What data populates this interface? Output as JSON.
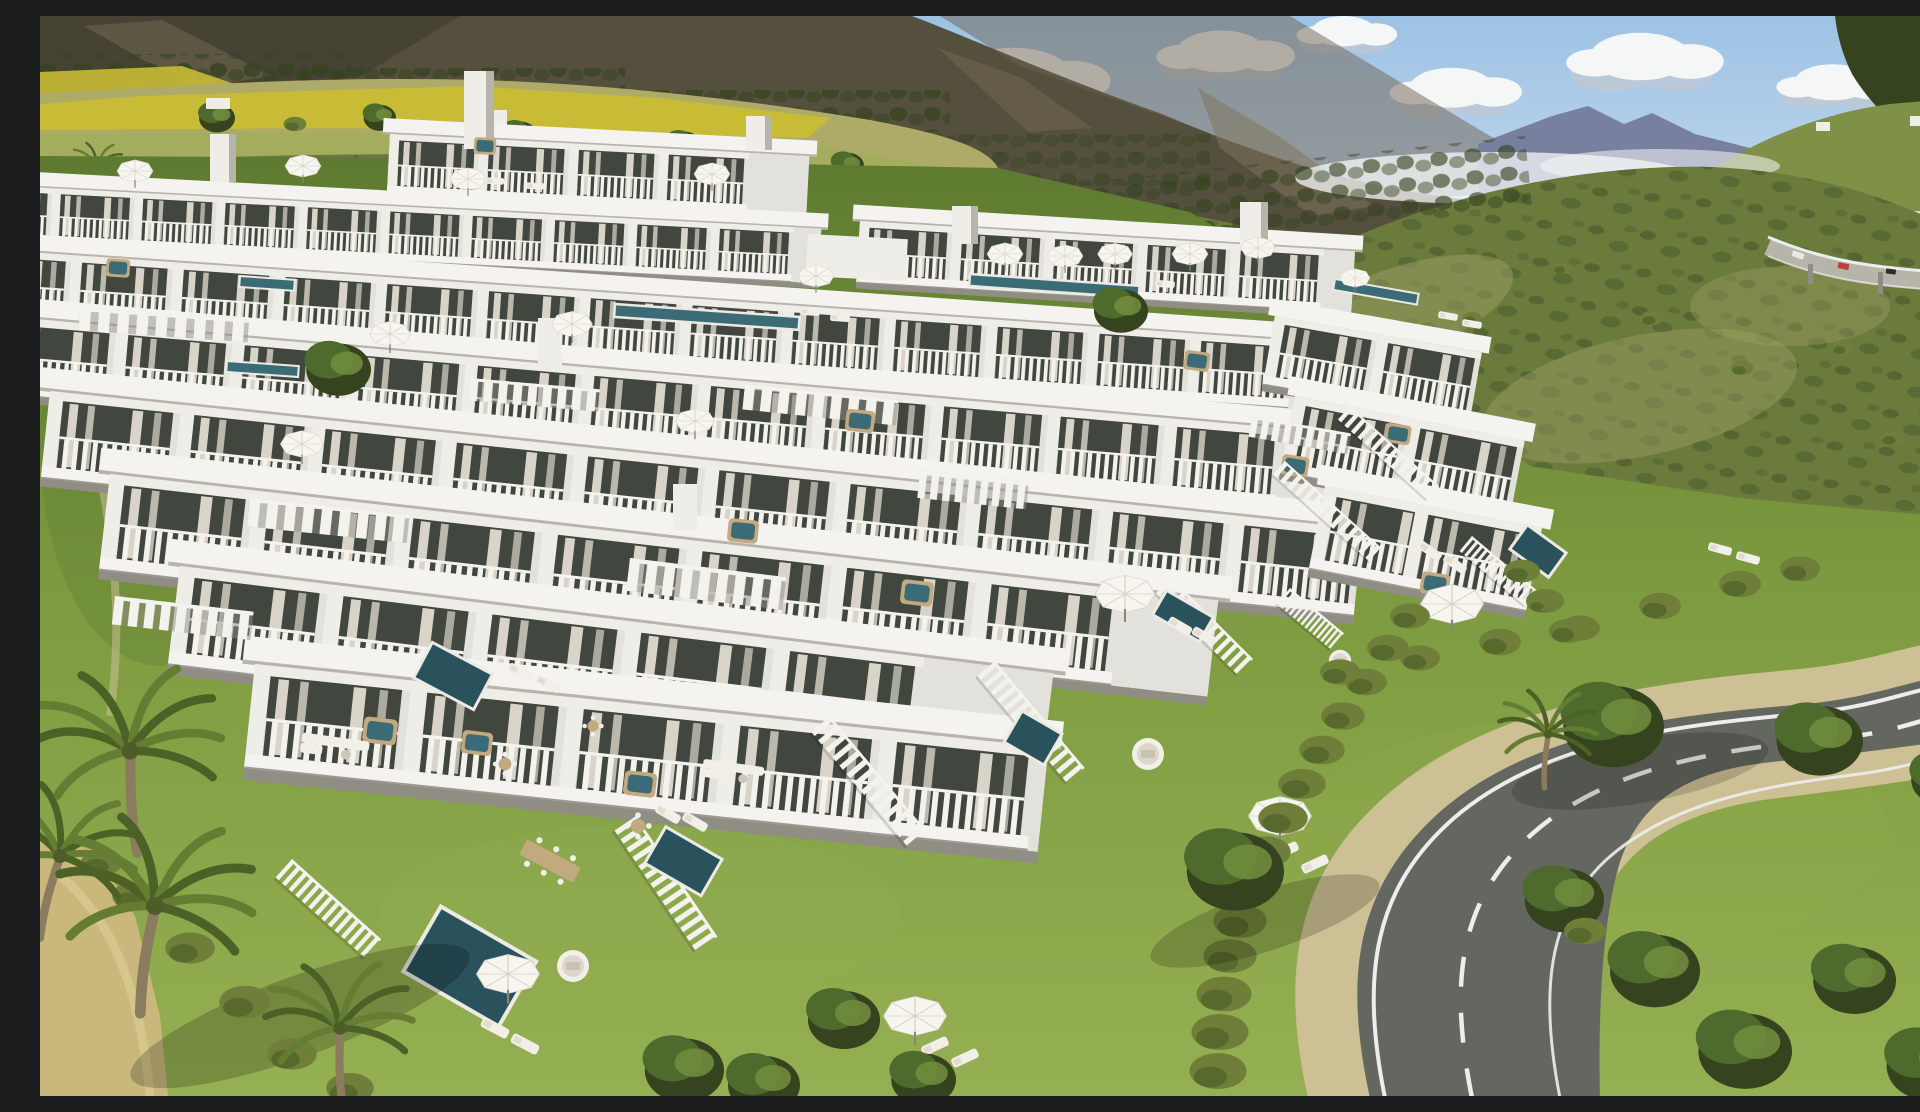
{
  "scene": {
    "description": "Aerial 3D render of a modern terraced white apartment complex on a Mediterranean hillside: stepped rows of balconies with glass fronts and curtains, slatted pergolas, rooftop lap pools, balcony hot tubs and white parasols; private lawned gardens below with plunge pools, picket fences, hedgerows, sun loungers, round daybeds and outdoor dining; a curving two-lane asphalt road with dashed centre line sweeps past palms and mature trees; behind rise yellow crop fields, farmhouses, scrub-covered green hills, a small highway viaduct with cars, dark mountain ridges, distant blue peaks and a cloud-filled blue sky.",
    "sky": {
      "clouds": "white cumulus over blue sky"
    },
    "background": [
      "dark mountain ridge",
      "distant blue peaks",
      "forested corner hill",
      "sunlit scrub hill",
      "yellow rapeseed field",
      "farmhouses",
      "highway viaduct with cars"
    ],
    "midground": [
      "terraced white apartment rows",
      "stair towers",
      "rooftop lap pools",
      "slatted pergolas",
      "balcony hot tubs",
      "roof-deck parasols"
    ],
    "foreground": [
      "private lawns",
      "white picket fences",
      "hedgerows",
      "plunge pools",
      "sun loungers",
      "round daybeds",
      "outdoor dining sets",
      "date palms",
      "curved asphalt road",
      "sandy footpath"
    ]
  },
  "colors": {
    "sky_top": "#9dc2e4",
    "sky_low": "#d9e7f2",
    "cloud": "#f5f7f7",
    "cloud_shade": "#c2c8d2",
    "ridge_blue": "#7880a0",
    "mountain_back": "#55503e",
    "mountain_shade": "#3a382c",
    "mountain_rock": "#80745a",
    "mountain_rocklight": "#6e6252",
    "forest_dark": "#35431f",
    "hill_far": "#7f9147",
    "hill_main": "#6b7b3c",
    "hill_dark": "#42522a",
    "hill_dry": "#a5a468",
    "field_yellow": "#c8bb35",
    "field_pale": "#adab67",
    "grass": "#7d9a40",
    "grass_light": "#95b052",
    "grass_shade": "#5e7a30",
    "hedge": "#6f7f3a",
    "hedge_dark": "#4c5d27",
    "tree_green": "#4e6a2d",
    "tree_light": "#6f8c3d",
    "palm_green": "#657d33",
    "palm_dark": "#4c6126",
    "trunk": "#8b7c60",
    "building_white": "#efede8",
    "building_face": "#e3e1db",
    "building_slab": "#f4f3ef",
    "building_shade": "#b7b4ac",
    "building_shadow": "#908d85",
    "window_glass": "#41463f",
    "window_frame": "#2e322c",
    "curtain": "#d9d4c8",
    "pool": "#3b6b77",
    "pool_dark": "#2a525d",
    "pool_coping": "#eceae2",
    "umbrella": "#f6f5f0",
    "furniture_white": "#f1efe8",
    "wood": "#c3a97f",
    "road_asphalt": "#64675f",
    "road_shoulder": "#cdc094",
    "road_line": "#eceded",
    "highway_deck": "#b7b5aa",
    "sand": "#c9b77c",
    "car_red": "#b8423a",
    "car_blue": "#3a4a7c",
    "car_white": "#e8e8e4",
    "car_dark": "#2e2e2e"
  }
}
